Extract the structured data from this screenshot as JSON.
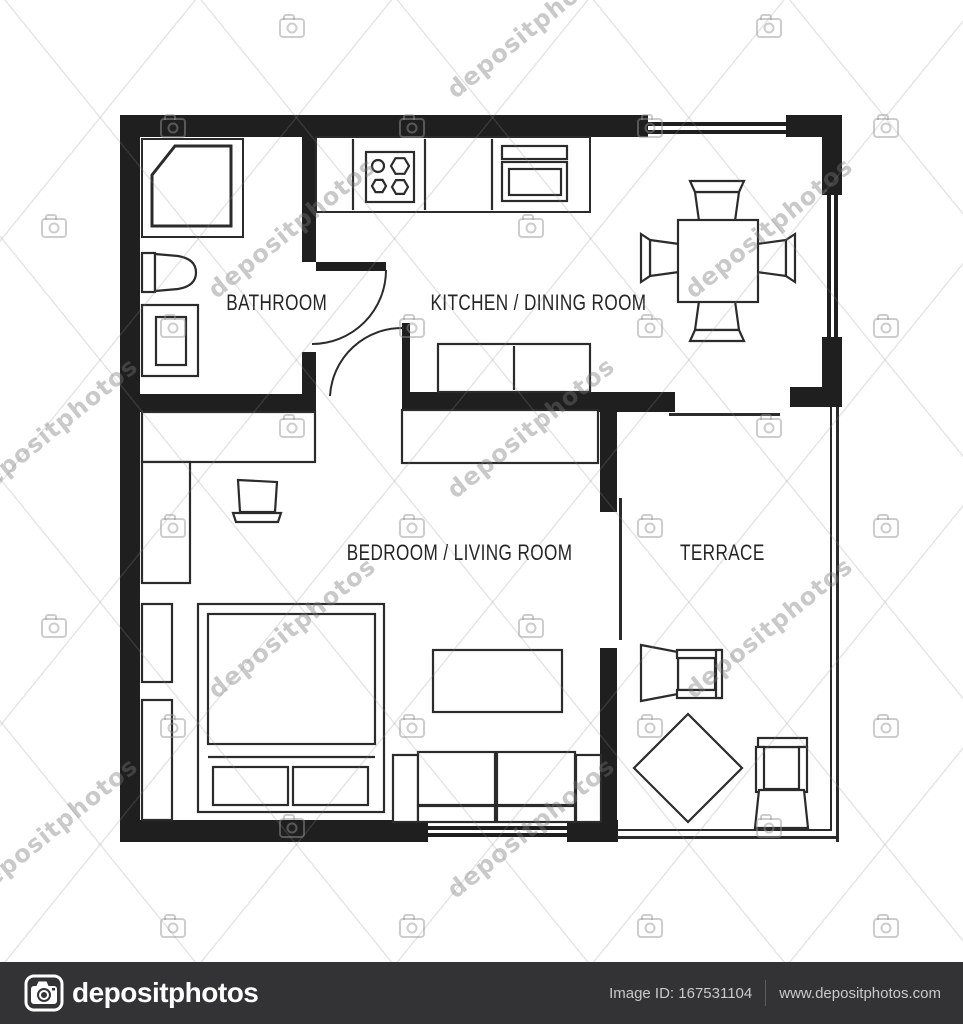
{
  "plan": {
    "rooms": [
      {
        "id": "bathroom",
        "label": "BATHROOM"
      },
      {
        "id": "kitchen-dining",
        "label": "KITCHEN / DINING ROOM"
      },
      {
        "id": "bedroom-living",
        "label": "BEDROOM / LIVING ROOM"
      },
      {
        "id": "terrace",
        "label": "TERRACE"
      }
    ],
    "wall_color": "#1f1f1f",
    "line_color": "#2b2b2b"
  },
  "watermark": {
    "text": "depositphotos",
    "rotation_deg": -39,
    "text_positions": [
      [
        292,
        228
      ],
      [
        769,
        228
      ],
      [
        531,
        428
      ],
      [
        54,
        428
      ],
      [
        292,
        628
      ],
      [
        769,
        628
      ],
      [
        531,
        828
      ],
      [
        531,
        28
      ],
      [
        54,
        828
      ]
    ],
    "camera_positions": [
      [
        173,
        128
      ],
      [
        412,
        128
      ],
      [
        650,
        128
      ],
      [
        886,
        128
      ],
      [
        173,
        328
      ],
      [
        412,
        328
      ],
      [
        650,
        328
      ],
      [
        886,
        328
      ],
      [
        173,
        528
      ],
      [
        412,
        528
      ],
      [
        650,
        528
      ],
      [
        886,
        528
      ],
      [
        173,
        728
      ],
      [
        412,
        728
      ],
      [
        650,
        728
      ],
      [
        886,
        728
      ],
      [
        173,
        928
      ],
      [
        412,
        928
      ],
      [
        650,
        928
      ],
      [
        886,
        928
      ],
      [
        531,
        228
      ],
      [
        292,
        428
      ],
      [
        769,
        428
      ],
      [
        531,
        628
      ],
      [
        292,
        828
      ],
      [
        769,
        828
      ],
      [
        54,
        228
      ],
      [
        54,
        628
      ],
      [
        292,
        28
      ],
      [
        769,
        28
      ]
    ]
  },
  "footer": {
    "brand": "depositphotos",
    "image_id": "Image ID: 167531104",
    "website": "www.depositphotos.com",
    "bar_color": "#333336"
  }
}
